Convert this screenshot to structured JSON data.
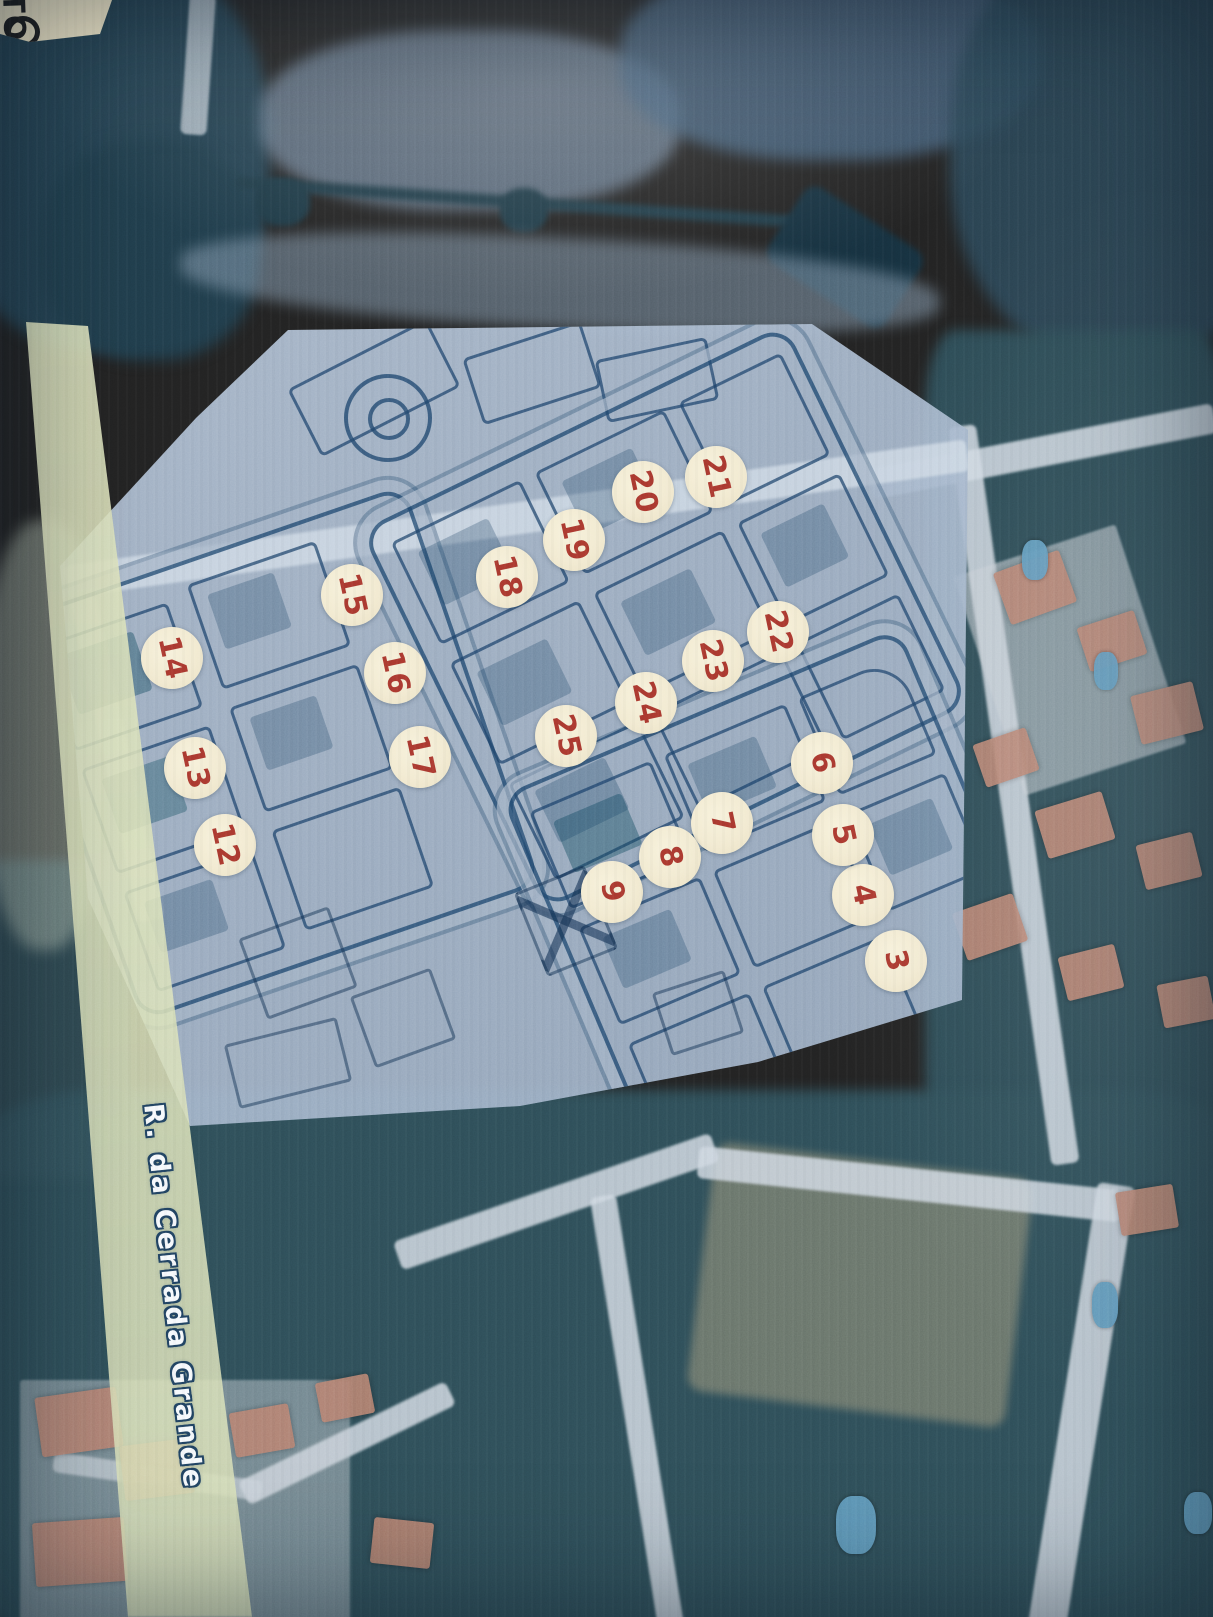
{
  "map": {
    "street_label": "R. da Cerrada Grande",
    "corner_label": "TO",
    "markers": [
      {
        "label": "3",
        "x": 896,
        "y": 961
      },
      {
        "label": "4",
        "x": 863,
        "y": 895
      },
      {
        "label": "5",
        "x": 843,
        "y": 835
      },
      {
        "label": "6",
        "x": 822,
        "y": 763
      },
      {
        "label": "7",
        "x": 722,
        "y": 823
      },
      {
        "label": "8",
        "x": 670,
        "y": 857
      },
      {
        "label": "9",
        "x": 612,
        "y": 892
      },
      {
        "label": "12",
        "x": 225,
        "y": 845
      },
      {
        "label": "13",
        "x": 195,
        "y": 768
      },
      {
        "label": "14",
        "x": 172,
        "y": 658
      },
      {
        "label": "15",
        "x": 352,
        "y": 595
      },
      {
        "label": "16",
        "x": 395,
        "y": 673
      },
      {
        "label": "17",
        "x": 420,
        "y": 757
      },
      {
        "label": "18",
        "x": 507,
        "y": 577
      },
      {
        "label": "19",
        "x": 574,
        "y": 540
      },
      {
        "label": "20",
        "x": 643,
        "y": 492
      },
      {
        "label": "21",
        "x": 716,
        "y": 477
      },
      {
        "label": "22",
        "x": 778,
        "y": 632
      },
      {
        "label": "23",
        "x": 713,
        "y": 661
      },
      {
        "label": "24",
        "x": 646,
        "y": 703
      },
      {
        "label": "25",
        "x": 566,
        "y": 736
      }
    ],
    "colors": {
      "marker_background": "#f2ead0",
      "marker_number": "#a8372e",
      "marker_glow": "#69be7d",
      "plan_paper": "#a9bdd4",
      "plan_line": "#22486e",
      "highlighted_road": "#dde3bd",
      "street_text": "#f6f9fc",
      "street_text_outline": "#20415f",
      "aerial_dark_vegetation": "#2c4a54",
      "aerial_light_road": "#ced7e0",
      "house_roof": "#b5806f",
      "swimming_pool": "#5f98bb",
      "corner_paper": "#efe6c6",
      "corner_text": "#1d1d1d"
    }
  }
}
